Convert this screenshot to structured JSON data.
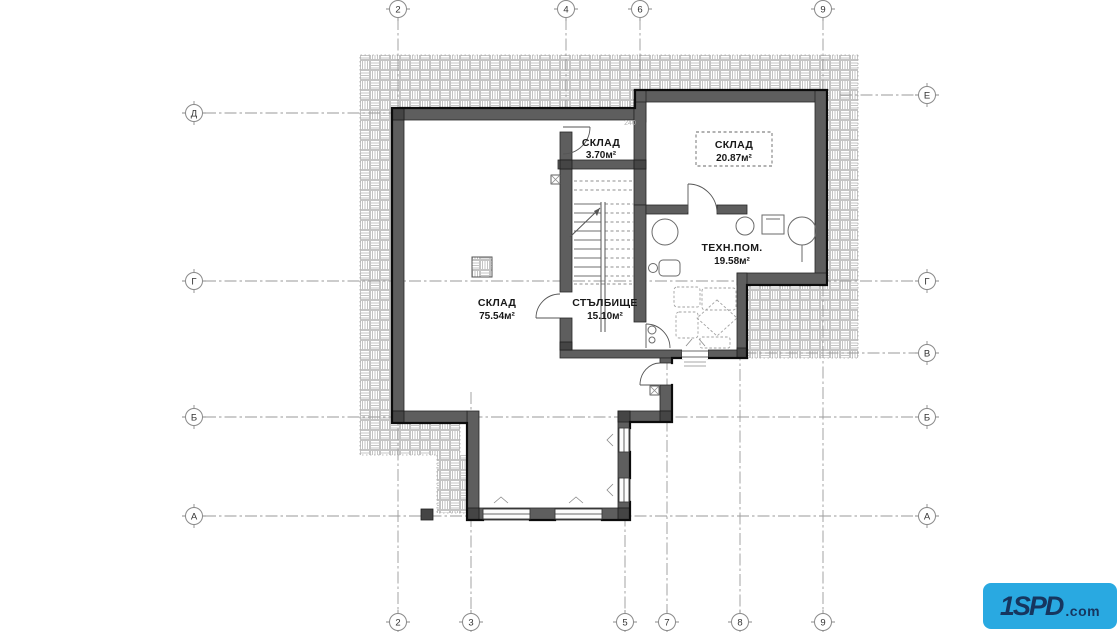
{
  "plan": {
    "title": "basement floor plan",
    "rooms": [
      {
        "name": "СКЛАД",
        "area": "3.70м²"
      },
      {
        "name": "СКЛАД",
        "area": "20.87м²"
      },
      {
        "name": "ТЕХН.ПОМ.",
        "area": "19.58м²"
      },
      {
        "name": "СКЛАД",
        "area": "75.54м²"
      },
      {
        "name": "СТЪЛБИЩЕ",
        "area": "15.10м²"
      }
    ],
    "grid": {
      "top": [
        {
          "label": "2"
        },
        {
          "label": "4"
        },
        {
          "label": "6"
        },
        {
          "label": "9"
        }
      ],
      "bottom": [
        {
          "label": "2"
        },
        {
          "label": "3"
        },
        {
          "label": "5"
        },
        {
          "label": "7"
        },
        {
          "label": "8"
        },
        {
          "label": "9"
        }
      ],
      "left": [
        {
          "label": "Д"
        },
        {
          "label": "Г"
        },
        {
          "label": "Б"
        },
        {
          "label": "А"
        }
      ],
      "right": [
        {
          "label": "Е"
        },
        {
          "label": "Г"
        },
        {
          "label": "В"
        },
        {
          "label": "Б"
        },
        {
          "label": "А"
        }
      ]
    },
    "annotations": {
      "dim": "240"
    }
  },
  "logo": {
    "main": "1SPD",
    "suffix": ".com"
  },
  "colors": {
    "wall": "#5e5e5e",
    "wall_pier": "#454545",
    "outline": "#0c0c0c",
    "grid_line": "#9a9a9a",
    "hatch": "#c4c4c4",
    "label_text": "#181818",
    "logo_bg": "#29a9e1",
    "logo_fg": "#16365f"
  }
}
